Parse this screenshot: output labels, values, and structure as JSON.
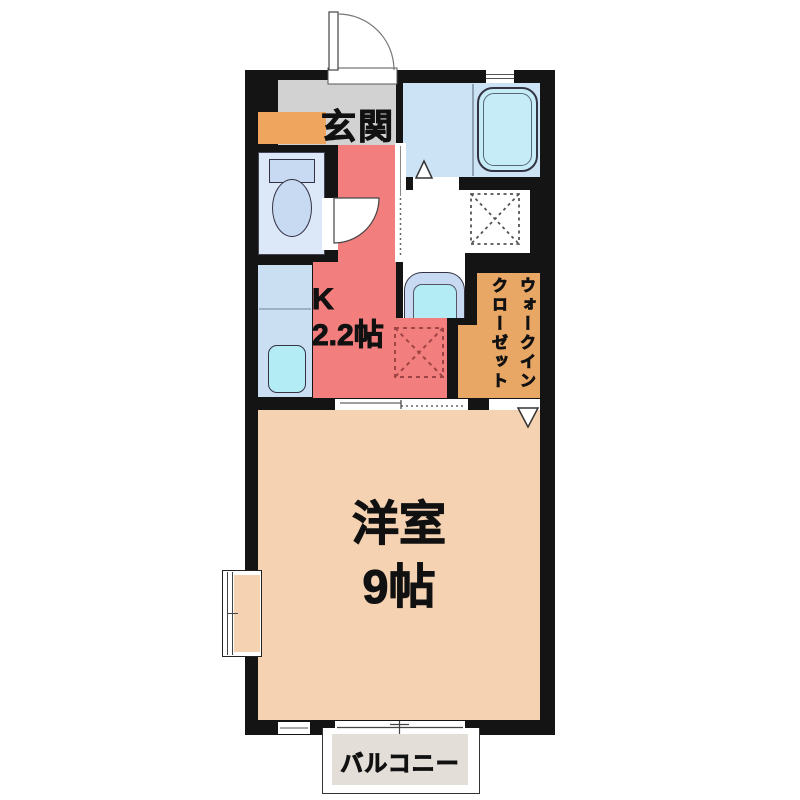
{
  "floorplan": {
    "entrance": {
      "label": "玄関"
    },
    "kitchen": {
      "label": "K\n2.2帖",
      "size_caption": "2.2帖"
    },
    "walk_in_closet": {
      "label": "ウォークイン\nクローゼット"
    },
    "western_room": {
      "label": "洋室\n9帖",
      "size_caption": "9帖"
    },
    "balcony": {
      "label": "バルコニー"
    },
    "fixtures": [
      "entrance-door",
      "shoe-cabinet",
      "toilet",
      "kitchen-counter-sink",
      "refrigerator-space",
      "washing-machine-space",
      "washbasin-vanity",
      "bathtub",
      "bath-door",
      "sliding-door",
      "bay-window",
      "balcony-window"
    ],
    "colors": {
      "wall": "#141414",
      "entrance_floor": "#d2d2d2",
      "kitchen": "#f37e7e",
      "main_room": "#f4d2b2",
      "closet": "#e9a766",
      "cabinet": "#f0a55e",
      "bath": "#cbe3f4",
      "toilet_room": "#dce8f7",
      "counter": "#cbdff3",
      "fixture_blue": "#c8daf2",
      "tub": "#c6ecf7",
      "sink_cyan": "#b4ecf5",
      "balcony_floor": "#e4ded8",
      "washroom": "#ffffff"
    }
  }
}
